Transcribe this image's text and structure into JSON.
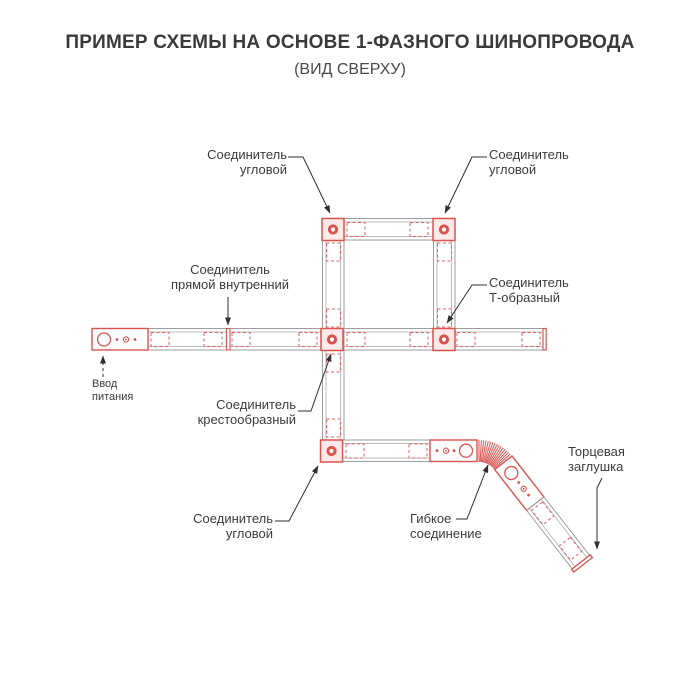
{
  "title": "ПРИМЕР СХЕМЫ НА ОСНОВЕ 1-ФАЗНОГО ШИНОПРОВОДА",
  "subtitle": "(ВИД СВЕРХУ)",
  "colors": {
    "connector_red": "#d9534f",
    "dashed_red": "#de6262",
    "track_gray": "#9e9e9e",
    "text": "#3c3c3c"
  },
  "labels": {
    "corner_top_left": {
      "line1": "Соединитель",
      "line2": "угловой"
    },
    "corner_top_right": {
      "line1": "Соединитель",
      "line2": "угловой"
    },
    "straight_internal": {
      "line1": "Соединитель",
      "line2": "прямой внутренний"
    },
    "t_connector": {
      "line1": "Соединитель",
      "line2": "Т-образный"
    },
    "cross_connector": {
      "line1": "Соединитель",
      "line2": "крестообразный"
    },
    "corner_bottom": {
      "line1": "Соединитель",
      "line2": "угловой"
    },
    "flexible": {
      "line1": "Гибкое",
      "line2": "соединение"
    },
    "end_cap": {
      "line1": "Торцевая",
      "line2": "заглушка"
    },
    "power_input": {
      "line1": "Ввод",
      "line2": "питания"
    }
  }
}
